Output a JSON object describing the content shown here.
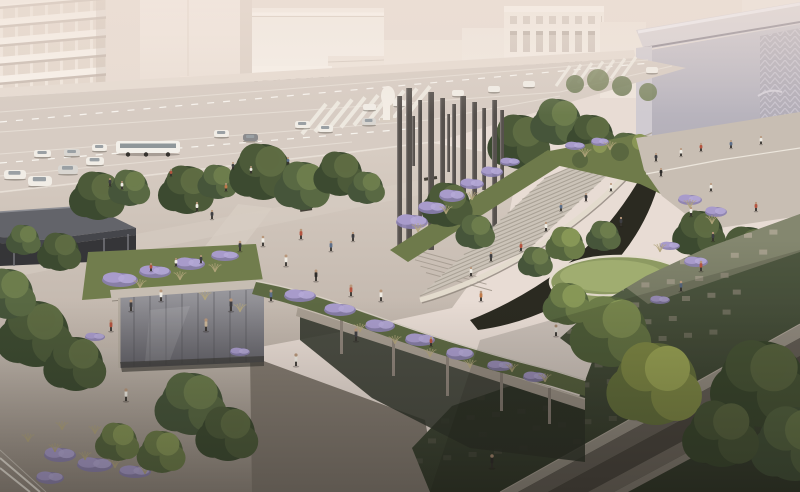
{
  "scene": {
    "type": "architectural-rendering",
    "subject": "aerial-view-urban-plaza-park",
    "palette": {
      "haze": "#e8dcd4",
      "building_white": "#f7f1ea",
      "building_shadow": "#c9bcb2",
      "building_right": "#b3aeb8",
      "street": "#d7ccc3",
      "plaza": "#d5cac0",
      "plaza_dark": "#968d84",
      "stairs": "#cbc3b8",
      "parapet": "#e3dbcd",
      "opening_dark": "#232219",
      "green_roof": "#8d9a62",
      "grass": "#59644a",
      "paver": "#b4aa99",
      "lavender": "#a89bcb",
      "pillar": "#56514d",
      "canopy": "#63646a",
      "glass": "#9a999e",
      "tree_dark": "#3c4a30",
      "tree_bright": "#a9b35c",
      "trunk": "#57483a",
      "head_tone": "#b8977b",
      "trench_top": "#a39a8f",
      "trench_floor": "#4f4942"
    },
    "tree_palettes": [
      [
        "#3c4a30",
        "#4c5a39",
        "#5e6c43"
      ],
      [
        "#46553a",
        "#596943",
        "#6d7d4d"
      ],
      [
        "#55653e",
        "#6d7d49",
        "#879757"
      ],
      [
        "#6d7940",
        "#8a954a",
        "#a9b35c"
      ]
    ],
    "trees": [
      {
        "x": 98,
        "y": 196,
        "r": 24,
        "p": 0,
        "layer": "back"
      },
      {
        "x": 130,
        "y": 188,
        "r": 18,
        "p": 1,
        "layer": "back"
      },
      {
        "x": 187,
        "y": 190,
        "r": 24,
        "p": 0,
        "layer": "back"
      },
      {
        "x": 218,
        "y": 182,
        "r": 17,
        "p": 1,
        "layer": "back"
      },
      {
        "x": 263,
        "y": 172,
        "r": 28,
        "p": 0,
        "layer": "back"
      },
      {
        "x": 303,
        "y": 186,
        "r": 24,
        "p": 1,
        "layer": "back"
      },
      {
        "x": 340,
        "y": 174,
        "r": 22,
        "p": 0,
        "layer": "back"
      },
      {
        "x": 367,
        "y": 188,
        "r": 16,
        "p": 1,
        "layer": "back"
      },
      {
        "x": 520,
        "y": 142,
        "r": 27,
        "p": 0,
        "layer": "back"
      },
      {
        "x": 558,
        "y": 122,
        "r": 23,
        "p": 1,
        "layer": "back"
      },
      {
        "x": 592,
        "y": 136,
        "r": 21,
        "p": 0,
        "layer": "back"
      },
      {
        "x": 628,
        "y": 152,
        "r": 19,
        "p": 1,
        "layer": "back"
      },
      {
        "x": 663,
        "y": 160,
        "r": 16,
        "p": 0,
        "layer": "back"
      },
      {
        "x": 700,
        "y": 168,
        "r": 20,
        "p": 1,
        "layer": "back"
      },
      {
        "x": 737,
        "y": 182,
        "r": 22,
        "p": 0,
        "layer": "back"
      },
      {
        "x": 60,
        "y": 252,
        "r": 19,
        "p": 0,
        "layer": "back"
      },
      {
        "x": 24,
        "y": 240,
        "r": 15,
        "p": 1,
        "layer": "back"
      },
      {
        "x": 448,
        "y": 205,
        "r": 22,
        "p": 0,
        "layer": "mid"
      },
      {
        "x": 476,
        "y": 232,
        "r": 17,
        "p": 1,
        "layer": "mid"
      },
      {
        "x": 536,
        "y": 262,
        "r": 15,
        "p": 1,
        "layer": "mid"
      },
      {
        "x": 566,
        "y": 244,
        "r": 17,
        "p": 2,
        "layer": "mid"
      },
      {
        "x": 604,
        "y": 236,
        "r": 15,
        "p": 1,
        "layer": "mid"
      },
      {
        "x": 700,
        "y": 234,
        "r": 23,
        "p": 0,
        "layer": "mid"
      },
      {
        "x": 748,
        "y": 254,
        "r": 27,
        "p": 0,
        "layer": "mid"
      },
      {
        "x": 781,
        "y": 294,
        "r": 25,
        "p": 1,
        "layer": "mid"
      },
      {
        "x": 36,
        "y": 334,
        "r": 33,
        "p": 0,
        "layer": "front"
      },
      {
        "x": 8,
        "y": 294,
        "r": 25,
        "p": 1,
        "layer": "front"
      },
      {
        "x": 76,
        "y": 364,
        "r": 27,
        "p": 0,
        "layer": "front"
      },
      {
        "x": 192,
        "y": 404,
        "r": 31,
        "p": 1,
        "layer": "front"
      },
      {
        "x": 228,
        "y": 434,
        "r": 27,
        "p": 0,
        "layer": "front"
      },
      {
        "x": 162,
        "y": 452,
        "r": 21,
        "p": 2,
        "layer": "front"
      },
      {
        "x": 612,
        "y": 332,
        "r": 35,
        "p": 2,
        "layer": "front"
      },
      {
        "x": 656,
        "y": 384,
        "r": 41,
        "p": 3,
        "layer": "front"
      },
      {
        "x": 568,
        "y": 304,
        "r": 21,
        "p": 2,
        "layer": "front"
      },
      {
        "x": 762,
        "y": 384,
        "r": 43,
        "p": 0,
        "layer": "front"
      },
      {
        "x": 795,
        "y": 444,
        "r": 37,
        "p": 1,
        "layer": "front"
      },
      {
        "x": 722,
        "y": 434,
        "r": 33,
        "p": 0,
        "layer": "front"
      },
      {
        "x": 118,
        "y": 442,
        "r": 19,
        "p": 2,
        "layer": "front"
      }
    ],
    "pillars": [
      {
        "x": 397,
        "y": 96,
        "h": 150,
        "w": 5
      },
      {
        "x": 406,
        "y": 88,
        "h": 168,
        "w": 6
      },
      {
        "x": 418,
        "y": 100,
        "h": 120,
        "w": 4
      },
      {
        "x": 428,
        "y": 92,
        "h": 158,
        "w": 6
      },
      {
        "x": 440,
        "y": 98,
        "h": 138,
        "w": 5
      },
      {
        "x": 452,
        "y": 104,
        "h": 92,
        "w": 4
      },
      {
        "x": 460,
        "y": 96,
        "h": 148,
        "w": 6
      },
      {
        "x": 472,
        "y": 102,
        "h": 112,
        "w": 5
      },
      {
        "x": 482,
        "y": 108,
        "h": 82,
        "w": 4
      },
      {
        "x": 492,
        "y": 100,
        "h": 128,
        "w": 5
      },
      {
        "x": 500,
        "y": 110,
        "h": 72,
        "w": 4
      },
      {
        "x": 447,
        "y": 114,
        "h": 58,
        "w": 3
      },
      {
        "x": 412,
        "y": 116,
        "h": 50,
        "w": 3
      }
    ],
    "cars": [
      {
        "x": 4,
        "y": 170,
        "w": 22,
        "h": 9
      },
      {
        "x": 28,
        "y": 176,
        "w": 24,
        "h": 10
      },
      {
        "x": 58,
        "y": 165,
        "w": 20,
        "h": 9,
        "c": "#d9d6d1"
      },
      {
        "x": 86,
        "y": 157,
        "w": 18,
        "h": 8
      },
      {
        "x": 34,
        "y": 150,
        "w": 17,
        "h": 7
      },
      {
        "x": 64,
        "y": 149,
        "w": 16,
        "h": 7,
        "c": "#d9d6d1"
      },
      {
        "x": 92,
        "y": 144,
        "w": 15,
        "h": 7
      },
      {
        "x": 214,
        "y": 130,
        "w": 15,
        "h": 7
      },
      {
        "x": 243,
        "y": 134,
        "w": 15,
        "h": 7,
        "c": "#8b8b8d"
      },
      {
        "x": 295,
        "y": 121,
        "w": 15,
        "h": 7
      },
      {
        "x": 318,
        "y": 125,
        "w": 15,
        "h": 7
      },
      {
        "x": 363,
        "y": 104,
        "w": 13,
        "h": 6
      },
      {
        "x": 393,
        "y": 100,
        "w": 12,
        "h": 6
      },
      {
        "x": 452,
        "y": 90,
        "w": 12,
        "h": 6
      },
      {
        "x": 488,
        "y": 86,
        "w": 12,
        "h": 6
      },
      {
        "x": 523,
        "y": 81,
        "w": 12,
        "h": 6
      },
      {
        "x": 646,
        "y": 67,
        "w": 12,
        "h": 6
      },
      {
        "x": 362,
        "y": 118,
        "w": 14,
        "h": 7,
        "c": "#d9d6d1"
      }
    ],
    "bus": {
      "x": 116,
      "y": 141,
      "w": 64,
      "h": 12
    },
    "people": [
      {
        "x": 110,
        "y": 186,
        "h": 6,
        "c": "#3e3e42"
      },
      {
        "x": 122,
        "y": 189,
        "h": 6,
        "c": "#efece4"
      },
      {
        "x": 171,
        "y": 176,
        "h": 5,
        "c": "#b5543f"
      },
      {
        "x": 233,
        "y": 169,
        "h": 5,
        "c": "#3e3e42"
      },
      {
        "x": 251,
        "y": 173,
        "h": 5,
        "c": "#efece4"
      },
      {
        "x": 288,
        "y": 164,
        "h": 5,
        "c": "#5d6f8a"
      },
      {
        "x": 226,
        "y": 191,
        "h": 6,
        "c": "#c07a4a"
      },
      {
        "x": 197,
        "y": 211,
        "h": 7,
        "c": "#efece4"
      },
      {
        "x": 212,
        "y": 219,
        "h": 7,
        "c": "#3e3e42"
      },
      {
        "x": 240,
        "y": 251,
        "h": 8,
        "c": "#3e3e42"
      },
      {
        "x": 263,
        "y": 246,
        "h": 8,
        "c": "#efece4"
      },
      {
        "x": 301,
        "y": 239,
        "h": 8,
        "c": "#b5543f"
      },
      {
        "x": 331,
        "y": 251,
        "h": 8,
        "c": "#5d6f8a"
      },
      {
        "x": 353,
        "y": 241,
        "h": 7,
        "c": "#3e3e42"
      },
      {
        "x": 286,
        "y": 266,
        "h": 9,
        "c": "#efece4"
      },
      {
        "x": 316,
        "y": 281,
        "h": 9,
        "c": "#2e2c2a"
      },
      {
        "x": 351,
        "y": 296,
        "h": 9,
        "c": "#b5543f"
      },
      {
        "x": 381,
        "y": 301,
        "h": 9,
        "c": "#efece4"
      },
      {
        "x": 271,
        "y": 301,
        "h": 9,
        "c": "#5d6f8a"
      },
      {
        "x": 231,
        "y": 311,
        "h": 10,
        "c": "#3e3e42"
      },
      {
        "x": 206,
        "y": 331,
        "h": 10,
        "c": "#c9b69a"
      },
      {
        "x": 161,
        "y": 301,
        "h": 9,
        "c": "#efece4"
      },
      {
        "x": 131,
        "y": 311,
        "h": 9,
        "c": "#3e3e42"
      },
      {
        "x": 111,
        "y": 331,
        "h": 9,
        "c": "#b5543f"
      },
      {
        "x": 471,
        "y": 276,
        "h": 7,
        "c": "#efece4"
      },
      {
        "x": 491,
        "y": 261,
        "h": 7,
        "c": "#3e3e42"
      },
      {
        "x": 521,
        "y": 251,
        "h": 7,
        "c": "#b5543f"
      },
      {
        "x": 546,
        "y": 231,
        "h": 7,
        "c": "#efece4"
      },
      {
        "x": 561,
        "y": 211,
        "h": 6,
        "c": "#5d6f8a"
      },
      {
        "x": 586,
        "y": 201,
        "h": 6,
        "c": "#3e3e42"
      },
      {
        "x": 611,
        "y": 191,
        "h": 6,
        "c": "#efece4"
      },
      {
        "x": 481,
        "y": 301,
        "h": 8,
        "c": "#c07a4a"
      },
      {
        "x": 656,
        "y": 161,
        "h": 6,
        "c": "#3e3e42"
      },
      {
        "x": 681,
        "y": 156,
        "h": 6,
        "c": "#efece4"
      },
      {
        "x": 701,
        "y": 151,
        "h": 6,
        "c": "#b5543f"
      },
      {
        "x": 731,
        "y": 148,
        "h": 6,
        "c": "#5d6f8a"
      },
      {
        "x": 761,
        "y": 144,
        "h": 6,
        "c": "#efece4"
      },
      {
        "x": 661,
        "y": 176,
        "h": 6,
        "c": "#2e2c2a"
      },
      {
        "x": 691,
        "y": 216,
        "h": 7,
        "c": "#efece4"
      },
      {
        "x": 713,
        "y": 241,
        "h": 7,
        "c": "#3e3e42"
      },
      {
        "x": 701,
        "y": 271,
        "h": 8,
        "c": "#b5543f"
      },
      {
        "x": 681,
        "y": 291,
        "h": 8,
        "c": "#5d6f8a"
      },
      {
        "x": 621,
        "y": 226,
        "h": 7,
        "c": "#3e3e42"
      },
      {
        "x": 756,
        "y": 211,
        "h": 7,
        "c": "#b5543f"
      },
      {
        "x": 711,
        "y": 191,
        "h": 6,
        "c": "#efece4"
      },
      {
        "x": 91,
        "y": 381,
        "h": 10,
        "c": "#3e3e42"
      },
      {
        "x": 126,
        "y": 401,
        "h": 10,
        "c": "#efece4"
      },
      {
        "x": 161,
        "y": 409,
        "h": 10,
        "c": "#b5543f"
      },
      {
        "x": 296,
        "y": 366,
        "h": 10,
        "c": "#efece4"
      },
      {
        "x": 356,
        "y": 341,
        "h": 10,
        "c": "#3e3e42"
      },
      {
        "x": 492,
        "y": 468,
        "h": 11,
        "c": "#2e2c2a"
      },
      {
        "x": 556,
        "y": 336,
        "h": 9,
        "c": "#efece4"
      },
      {
        "x": 151,
        "y": 271,
        "h": 6,
        "c": "#b5543f"
      },
      {
        "x": 176,
        "y": 266,
        "h": 6,
        "c": "#efece4"
      },
      {
        "x": 201,
        "y": 263,
        "h": 6,
        "c": "#3e3e42"
      },
      {
        "x": 431,
        "y": 346,
        "h": 7,
        "c": "#b5543f"
      }
    ],
    "lavender": [
      {
        "x": 412,
        "y": 222,
        "rx": 16,
        "ry": 7
      },
      {
        "x": 432,
        "y": 208,
        "rx": 14,
        "ry": 6
      },
      {
        "x": 452,
        "y": 196,
        "rx": 13,
        "ry": 6
      },
      {
        "x": 472,
        "y": 184,
        "rx": 12,
        "ry": 5
      },
      {
        "x": 492,
        "y": 172,
        "rx": 11,
        "ry": 5
      },
      {
        "x": 510,
        "y": 162,
        "rx": 10,
        "ry": 4
      },
      {
        "x": 120,
        "y": 280,
        "rx": 18,
        "ry": 7
      },
      {
        "x": 155,
        "y": 272,
        "rx": 16,
        "ry": 6
      },
      {
        "x": 190,
        "y": 264,
        "rx": 15,
        "ry": 6
      },
      {
        "x": 225,
        "y": 256,
        "rx": 14,
        "ry": 5
      },
      {
        "x": 300,
        "y": 296,
        "rx": 16,
        "ry": 6
      },
      {
        "x": 340,
        "y": 310,
        "rx": 16,
        "ry": 6
      },
      {
        "x": 380,
        "y": 326,
        "rx": 15,
        "ry": 6
      },
      {
        "x": 420,
        "y": 340,
        "rx": 15,
        "ry": 6
      },
      {
        "x": 460,
        "y": 354,
        "rx": 14,
        "ry": 6
      },
      {
        "x": 500,
        "y": 366,
        "rx": 13,
        "ry": 5
      },
      {
        "x": 535,
        "y": 377,
        "rx": 12,
        "ry": 5
      },
      {
        "x": 690,
        "y": 200,
        "rx": 12,
        "ry": 5
      },
      {
        "x": 716,
        "y": 212,
        "rx": 11,
        "ry": 5
      },
      {
        "x": 670,
        "y": 246,
        "rx": 10,
        "ry": 4
      },
      {
        "x": 696,
        "y": 262,
        "rx": 12,
        "ry": 5
      },
      {
        "x": 660,
        "y": 300,
        "rx": 10,
        "ry": 4
      },
      {
        "x": 60,
        "y": 455,
        "rx": 16,
        "ry": 7
      },
      {
        "x": 95,
        "y": 465,
        "rx": 18,
        "ry": 7
      },
      {
        "x": 135,
        "y": 472,
        "rx": 16,
        "ry": 6
      },
      {
        "x": 50,
        "y": 478,
        "rx": 14,
        "ry": 6
      },
      {
        "x": 95,
        "y": 337,
        "rx": 10,
        "ry": 4
      },
      {
        "x": 240,
        "y": 352,
        "rx": 10,
        "ry": 4
      },
      {
        "x": 575,
        "y": 146,
        "rx": 10,
        "ry": 4
      },
      {
        "x": 600,
        "y": 142,
        "rx": 9,
        "ry": 4
      }
    ],
    "grasses": [
      {
        "x": 28,
        "y": 442
      },
      {
        "x": 55,
        "y": 452
      },
      {
        "x": 85,
        "y": 460
      },
      {
        "x": 115,
        "y": 468
      },
      {
        "x": 145,
        "y": 474
      },
      {
        "x": 95,
        "y": 434
      },
      {
        "x": 62,
        "y": 430
      },
      {
        "x": 360,
        "y": 332
      },
      {
        "x": 395,
        "y": 344
      },
      {
        "x": 430,
        "y": 357
      },
      {
        "x": 470,
        "y": 368
      },
      {
        "x": 205,
        "y": 300
      },
      {
        "x": 240,
        "y": 312
      },
      {
        "x": 418,
        "y": 232
      },
      {
        "x": 446,
        "y": 214
      },
      {
        "x": 472,
        "y": 200
      },
      {
        "x": 690,
        "y": 208
      },
      {
        "x": 712,
        "y": 224
      },
      {
        "x": 660,
        "y": 252
      },
      {
        "x": 585,
        "y": 157
      },
      {
        "x": 610,
        "y": 150
      },
      {
        "x": 140,
        "y": 288
      },
      {
        "x": 180,
        "y": 280
      },
      {
        "x": 215,
        "y": 272
      },
      {
        "x": 545,
        "y": 382
      },
      {
        "x": 512,
        "y": 372
      }
    ],
    "paver_grid": {
      "ox": 470,
      "oy": 248,
      "cx": 26,
      "cy": -3.2,
      "rx": -12,
      "ry": 20,
      "rows": 12,
      "cols": 13,
      "w": 8,
      "h": 5,
      "color": "#b4aa99"
    },
    "stairs": {
      "x0": 420,
      "y0": 296,
      "dx": 7.3,
      "dy": -6.9,
      "lx": 108,
      "ly": -46,
      "count": 18
    },
    "crosswalks": [
      {
        "x": 302,
        "y": 134,
        "sx": 13,
        "sy": -2.2,
        "lx": 24,
        "ly": -30,
        "n": 9,
        "w": 4
      },
      {
        "x": 556,
        "y": 86,
        "sx": 11,
        "sy": -1.5,
        "lx": 14,
        "ly": -20,
        "n": 7,
        "w": 3
      },
      {
        "x": 4,
        "y": 208,
        "sx": 22,
        "sy": -3,
        "lx": 20,
        "ly": -14,
        "n": 6,
        "w": 5
      }
    ]
  }
}
